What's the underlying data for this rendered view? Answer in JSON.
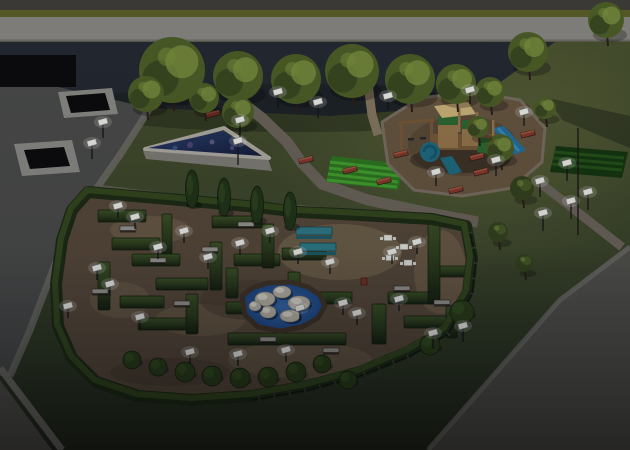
{
  "scene": {
    "setting": "aerial 3D landscape render of a park at dusk",
    "areas": [
      "paved plaza with sunken planters",
      "triangular fountain pool",
      "tree row along dark lot",
      "wooden playground with blue slides",
      "hedge maze with gravel paths",
      "boulder pond",
      "picnic and chess tables courtyard",
      "crop beds",
      "perimeter roads"
    ]
  },
  "palette": {
    "curb_dark": "#403f39",
    "median_green": "#5c6126",
    "road_light": "#8d8b85",
    "dark_lot": "#252a33",
    "black_void": "#0c0c0e",
    "plaza": "#4c4d4b",
    "sidewalk": "#71706a",
    "road_dark": "#55544f",
    "planter_frame": "#8e8e89",
    "path_gray": "#6e675c",
    "path_dirt": "#8a7a62",
    "play_dirt": "#6a5942",
    "path_edge": "#7d7264",
    "mulch": "#5d4c38",
    "dirt": "#5a4b3b",
    "gravel": "#7b6b52",
    "dirt_dark": "#473a2d",
    "hedge_dark": "#1f2c15",
    "hedge_lit": "#35491f",
    "pool_wall": "#83817a",
    "pool_rim": "#b5b2a9",
    "pond_shore": "#433627",
    "boulder": "#bfb9ab",
    "boulder_hi": "#e3dfd2",
    "lamp": "#f4f4ef",
    "bench_red": "#8a3c2c",
    "bench_seat": "#9a9a93",
    "table_teal": "#2f7e8a",
    "table_white": "#e9e9e3",
    "wood": "#9a7a4e",
    "wood_dark": "#7a5c38",
    "panel_green": "#2e6b33",
    "slide_teal": "#1f6f85",
    "slide_blue": "#2573a0",
    "canopy": "#d2b87c",
    "crop_bright": "#46a52e",
    "crop_base": "#2f7a22",
    "crop_dark_base": "#17380f",
    "crop_dark_row": "#25541a",
    "tree_mid": "#4e6128",
    "tree_dark": "#36451f",
    "tree_light": "#7e9440",
    "poplar": "#223618",
    "shrub": "#2c4019"
  },
  "objects": {
    "canopy_trees": [
      [
        172,
        70,
        33,
        0
      ],
      [
        146,
        94,
        18,
        1
      ],
      [
        238,
        76,
        25,
        1
      ],
      [
        296,
        79,
        25,
        0
      ],
      [
        352,
        71,
        27,
        1
      ],
      [
        410,
        79,
        25,
        0
      ],
      [
        456,
        84,
        20,
        1
      ],
      [
        490,
        92,
        15,
        0
      ],
      [
        528,
        52,
        20,
        1
      ],
      [
        606,
        20,
        18,
        0
      ],
      [
        204,
        98,
        15,
        1
      ],
      [
        238,
        112,
        16,
        0
      ],
      [
        500,
        148,
        14,
        1
      ],
      [
        478,
        127,
        11,
        0
      ],
      [
        522,
        188,
        12,
        2
      ],
      [
        498,
        232,
        10,
        2
      ],
      [
        524,
        263,
        9,
        2
      ],
      [
        545,
        108,
        11,
        1
      ]
    ],
    "poplars": [
      [
        192,
        189
      ],
      [
        224,
        197
      ],
      [
        257,
        205
      ],
      [
        290,
        211
      ]
    ],
    "maze_walls": [
      [
        98,
        210,
        48,
        12
      ],
      [
        162,
        214,
        10,
        42
      ],
      [
        112,
        238,
        48,
        12
      ],
      [
        98,
        262,
        12,
        48
      ],
      [
        132,
        254,
        48,
        12
      ],
      [
        156,
        278,
        52,
        12
      ],
      [
        120,
        296,
        44,
        12
      ],
      [
        138,
        318,
        60,
        12
      ],
      [
        186,
        294,
        12,
        40
      ],
      [
        212,
        216,
        50,
        12
      ],
      [
        210,
        242,
        12,
        48
      ],
      [
        234,
        254,
        46,
        12
      ],
      [
        226,
        302,
        58,
        12
      ],
      [
        262,
        224,
        12,
        44
      ],
      [
        282,
        248,
        44,
        12
      ],
      [
        288,
        272,
        12,
        40
      ],
      [
        228,
        333,
        118,
        12
      ],
      [
        226,
        268,
        12,
        30
      ],
      [
        302,
        292,
        50,
        12
      ],
      [
        388,
        292,
        46,
        12
      ],
      [
        428,
        218,
        12,
        86
      ],
      [
        440,
        266,
        26,
        11
      ],
      [
        372,
        304,
        14,
        40
      ],
      [
        404,
        316,
        46,
        12
      ],
      [
        446,
        306,
        11,
        32
      ]
    ],
    "maze_shrubs": [
      [
        132,
        360,
        9
      ],
      [
        158,
        367,
        9
      ],
      [
        185,
        372,
        10
      ],
      [
        212,
        376,
        10
      ],
      [
        240,
        378,
        10
      ],
      [
        268,
        377,
        10
      ],
      [
        296,
        372,
        10
      ],
      [
        322,
        364,
        9
      ],
      [
        348,
        380,
        9
      ],
      [
        462,
        312,
        12
      ],
      [
        430,
        345,
        10
      ]
    ],
    "boulders": [
      [
        265,
        299,
        10,
        7
      ],
      [
        282,
        292,
        9,
        6
      ],
      [
        299,
        303,
        11,
        7
      ],
      [
        268,
        312,
        8,
        6
      ],
      [
        290,
        316,
        10,
        6
      ],
      [
        255,
        306,
        6,
        5
      ]
    ],
    "picnic_tables": [
      [
        314,
        231
      ],
      [
        318,
        247
      ]
    ],
    "chess_tables": [
      [
        388,
        238
      ],
      [
        404,
        247
      ],
      [
        390,
        258
      ],
      [
        408,
        263
      ]
    ],
    "maze_benches": [
      [
        128,
        228
      ],
      [
        100,
        291
      ],
      [
        182,
        303
      ],
      [
        246,
        224
      ],
      [
        210,
        249
      ],
      [
        268,
        339
      ],
      [
        331,
        350
      ],
      [
        402,
        288
      ],
      [
        442,
        302
      ],
      [
        158,
        260
      ]
    ],
    "park_benches": [
      [
        306,
        160
      ],
      [
        350,
        170
      ],
      [
        384,
        181
      ],
      [
        401,
        154
      ],
      [
        477,
        157
      ],
      [
        481,
        172
      ],
      [
        528,
        134
      ],
      [
        522,
        190
      ],
      [
        285,
        88
      ],
      [
        213,
        114
      ],
      [
        456,
        190
      ]
    ],
    "lamps": [
      [
        103,
        122,
        16
      ],
      [
        92,
        143,
        16
      ],
      [
        240,
        120,
        24
      ],
      [
        238,
        141,
        24
      ],
      [
        278,
        92,
        16
      ],
      [
        318,
        102,
        16
      ],
      [
        388,
        96,
        14
      ],
      [
        470,
        90,
        14
      ],
      [
        524,
        112,
        14
      ],
      [
        436,
        172,
        14
      ],
      [
        496,
        160,
        16
      ],
      [
        540,
        181,
        16
      ],
      [
        567,
        163,
        18
      ],
      [
        588,
        192,
        18
      ],
      [
        571,
        201,
        18
      ],
      [
        543,
        213,
        18
      ],
      [
        135,
        217,
        12
      ],
      [
        97,
        268,
        12
      ],
      [
        158,
        247,
        12
      ],
      [
        184,
        231,
        12
      ],
      [
        240,
        243,
        12
      ],
      [
        208,
        257,
        12
      ],
      [
        270,
        231,
        12
      ],
      [
        298,
        252,
        12
      ],
      [
        330,
        262,
        12
      ],
      [
        392,
        252,
        12
      ],
      [
        417,
        242,
        12
      ],
      [
        300,
        308,
        12
      ],
      [
        343,
        303,
        12
      ],
      [
        399,
        299,
        12
      ],
      [
        357,
        313,
        12
      ],
      [
        140,
        317,
        12
      ],
      [
        110,
        284,
        12
      ],
      [
        190,
        352,
        12
      ],
      [
        238,
        354,
        12
      ],
      [
        286,
        350,
        12
      ],
      [
        68,
        306,
        12
      ],
      [
        433,
        333,
        16
      ],
      [
        463,
        326,
        16
      ],
      [
        118,
        206,
        12
      ]
    ]
  }
}
